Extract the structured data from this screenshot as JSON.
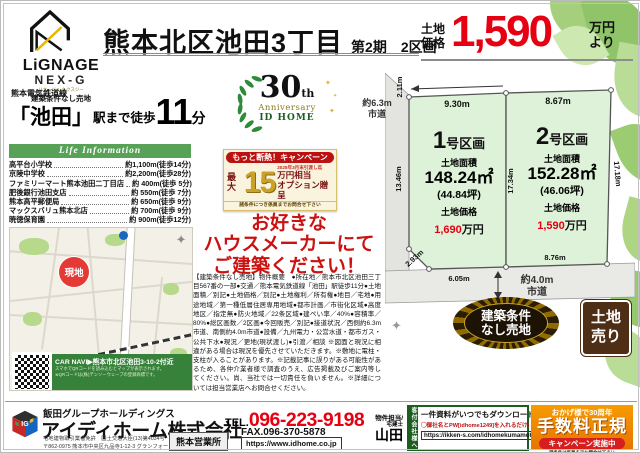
{
  "header": {
    "logo": {
      "brand": "LiGNAGE",
      "sub": "NEX-G",
      "ruby": "リナージュ ネクスジー",
      "tag": "建築条件なし売地"
    },
    "title": "熊本北区池田3丁目",
    "phase": "第2期　2区画",
    "price_label1": "土地",
    "price_label2": "価格",
    "price": "1,590",
    "price_unit1": "万円",
    "price_unit2": "より",
    "accent_red": "#e60012"
  },
  "access": {
    "line": "熊本電気鉄道線",
    "station": "「池田」",
    "mid": "駅まで徒歩",
    "minutes": "11",
    "unit": "分"
  },
  "life_info": {
    "heading": "Life Information",
    "items": [
      {
        "name": "高平台小学校",
        "value": "約1,100m(徒歩14分)"
      },
      {
        "name": "京陵中学校",
        "value": "約2,200m(徒歩28分)"
      },
      {
        "name": "ファミリーマート熊本池田二丁目店",
        "value": "約 400m(徒歩 5分)"
      },
      {
        "name": "肥後銀行池田支店",
        "value": "約 550m(徒歩 7分)"
      },
      {
        "name": "熊本高平郵便局",
        "value": "約 650m(徒歩 9分)"
      },
      {
        "name": "マックスバリュ熊本北店",
        "value": "約 700m(徒歩 9分)"
      },
      {
        "name": "暁徳保育園",
        "value": "約 900m(徒歩12分)"
      }
    ]
  },
  "map": {
    "marker": "現地",
    "station": "池田駅",
    "carnavi": "CAR NAVI▶熊本市北区池田3-10-2付近",
    "carnavi_note1": "スマホでQRコードを読み込むとマップが表示されます。",
    "carnavi_note2": "※QRコードは(株)デンソーウェーブの登録商標です。"
  },
  "anniversary": {
    "num": "30",
    "th": "th",
    "line1": "Anniversary",
    "line2": "ID HOME"
  },
  "campaign": {
    "header": "もっと断熱！キャンペーン",
    "max": "最大",
    "amount": "15",
    "date": "2025年3月末引渡し迄",
    "unit1": "万円相当",
    "unit2": "オプション贈呈",
    "note": "諸条件につき係員までお問合せ下さい"
  },
  "appeal": {
    "l1": "お好きな",
    "l2": "ハウスメーカーにて",
    "l3": "ご建築ください！"
  },
  "description": "【建築条件なし売地】物件概要　●所在地／熊本市北区池田三丁目567番の一部●交通／熊本電気鉄道線「池田」駅徒歩11分●土地面積／別記●土地価格／別記●土地権利／所有権●地目／宅地●用途地域／第一種低層住居専用地域●都市計画／市街化区域●高度地区／指定無●防火地域／22条区域●建ぺい率／40%●容積率／80%●総区画数／2区画●今回販売／別記●接道状況／西側約6.3m市道、南側約4.0m市道●設備／九州電力・公営水道・都市ガス・公共下水●現況／更地(現状渡し)●引渡／相談 ※図面と現況に相違がある場合は現況を優先させていただきます。※敷地に電柱・支柱が入ることがあります。※記載記事に誤りがある可能性があるため、各仲介業者様で調査のうえ、広告掲載及びご案内等してください。尚、当社では一切責任を負いません。※詳細については担当営業店へお問合せください。",
  "plots": {
    "road_left1": "約6.3m",
    "road_left2": "市道",
    "road_bottom1": "約4.0m",
    "road_bottom2": "市道",
    "lot1": {
      "num": "1",
      "suffix": "号区画",
      "area_label": "土地面積",
      "area": "148.24㎡",
      "tsubo": "(44.84坪)",
      "price_label": "土地価格",
      "price": "1,690",
      "price_unit": "万円",
      "dim_top": "9.30m",
      "dim_tl": "2.11m",
      "dim_left": "13.46m",
      "dim_diag": "2.93m",
      "dim_bottom": "6.05m"
    },
    "lot2": {
      "num": "2",
      "suffix": "号区画",
      "area_label": "土地面積",
      "area": "152.28㎡",
      "tsubo": "(46.06坪)",
      "price_label": "土地価格",
      "price": "1,590",
      "price_unit": "万円",
      "dim_top": "8.67m",
      "dim_mid": "17.34m",
      "dim_right": "17.18m",
      "dim_bottom": "8.76m"
    }
  },
  "badges": {
    "starburst1": "建築条件",
    "starburst2": "なし売地",
    "tochi1": "土地",
    "tochi2": "売り"
  },
  "footer": {
    "group": "飯田グループホールディングス",
    "logo_text": "IG",
    "company": "アイディホーム株式会社",
    "license1": "宅地建物取引業者免許　国土交通大臣(13)第4034号",
    "license2": "〒862-0975 熊本市中央区九品寺1-12-3 グランフォーレ九品寺101号室",
    "office": "熊本営業所",
    "tel_label": "TEL.",
    "tel": "096-223-9198",
    "fax": "FAX.096-370-5878",
    "url": "https://www.idhome.co.jp",
    "contact1": "物件担当/",
    "contact2": "宅建士",
    "contact3": "山田",
    "dl_side": "客付会社様へ",
    "dl_line1": "一件資料がいつでもダウンロードできます",
    "dl_line2": "◯御社名とPW[idhome1249]を入れるだけ!",
    "dl_url": "https://ikken-s.com/idhomekumamoto",
    "orange1": "おかげ様で30周年",
    "orange2": "手数料正規",
    "orange3": "キャンペーン実施中",
    "orange4": "諸条件は係員までお問合せ下さい"
  }
}
